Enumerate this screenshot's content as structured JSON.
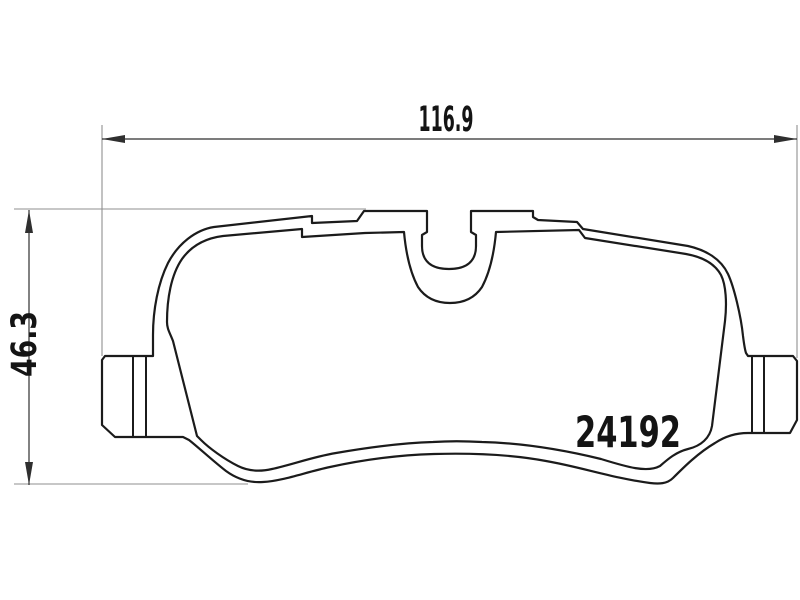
{
  "drawing": {
    "part_number": "24192",
    "width_dimension_label": "116.9",
    "height_dimension_label": "46.3",
    "colors": {
      "background": "#ffffff",
      "outline": "#1b1b1b",
      "dimension": "#2f2f2f",
      "extension": "#8f8f8f",
      "text": "#141414"
    }
  }
}
